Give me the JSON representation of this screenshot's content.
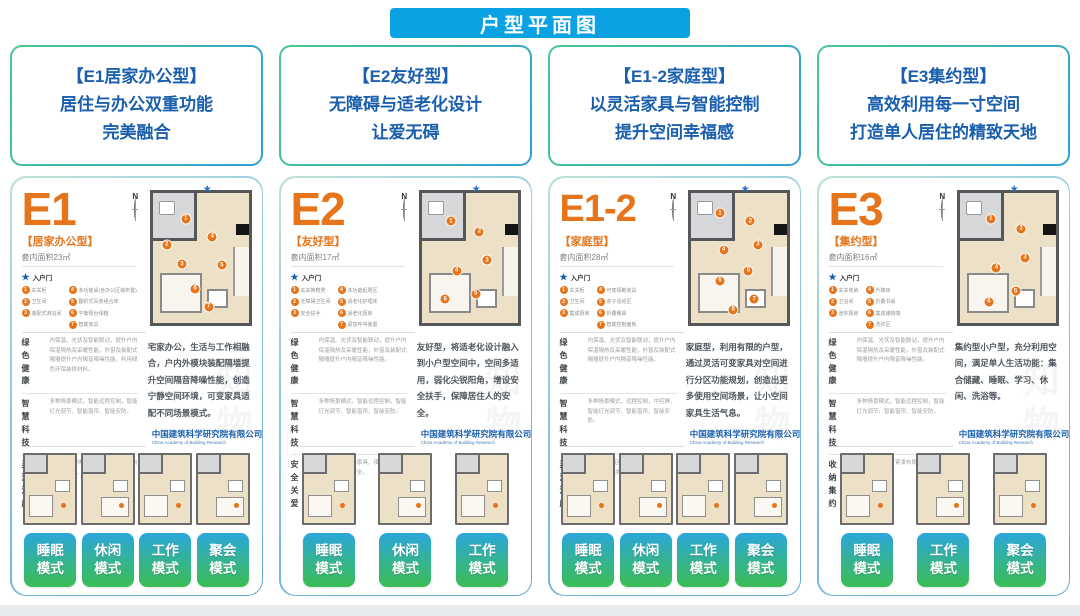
{
  "banner": {
    "title": "户型平面图"
  },
  "intro_cards": [
    {
      "title": "【E1居家办公型】",
      "line1": "居住与办公双重功能",
      "line2": "完美融合"
    },
    {
      "title": "【E2友好型】",
      "line1": "无障碍与适老化设计",
      "line2": "让爱无碍"
    },
    {
      "title": "【E1-2家庭型】",
      "line1": "以灵活家具与智能控制",
      "line2": "提升空间幸福感"
    },
    {
      "title": "【E3集约型】",
      "line1": "高效利用每一寸空间",
      "line2": "打造单人居住的精致天地"
    }
  ],
  "entry_label": "入户门",
  "compass_label": "N",
  "mode_suffix": "模式",
  "watermark": "知物",
  "logo": {
    "cn": "中国建筑科学研究院有限公司",
    "en": "China Academy of Building Research"
  },
  "panels": [
    {
      "code": "E1",
      "subtitle": "【居家办公型】",
      "area": "套内面积23㎡",
      "legend_left": [
        "玄关柜",
        "卫生间",
        "装配式淋浴间"
      ],
      "legend_right": [
        "多功能桌(含办公区域布置)",
        "翻折式百变组合床",
        "平衡阳台绿植",
        "智能家具"
      ],
      "sections": [
        {
          "label1": "绿 色",
          "label2": "健 康",
          "text": "内保温、光伏及智能联动，提升户内保温隔热及采暖性能，外窗及装配式隔墙提升户内隔音降噪性能，利用绿色环保装修材料。"
        },
        {
          "label1": "智 慧",
          "label2": "科 技",
          "text": "多种情景模式，智能远程控制，智能灯光调节、智能窗帘、智能安防。"
        },
        {
          "label1": "灵 活",
          "label2": "温 度",
          "text": "可变家具模块，平衡节省，丰富室内居家、办公、休闲场景。"
        }
      ],
      "description": "宅家办公，生活与工作相融合，户内外模块装配隔墙提升空间隔音降噪性能，创造宁静空间环境，可变家具适配不同场景模式。",
      "modes": [
        "睡眠",
        "休闲",
        "工作",
        "聚会"
      ]
    },
    {
      "code": "E2",
      "subtitle": "【友好型】",
      "area": "套内面积17㎡",
      "legend_left": [
        "玄关换鞋凳",
        "无障碍卫生间",
        "安全扶手"
      ],
      "legend_right": [
        "多功能起居区",
        "适老化护理床",
        "适老化厨房",
        "紧急呼叫装置"
      ],
      "sections": [
        {
          "label1": "绿 色",
          "label2": "健 康",
          "text": "内保温、光伏及智能联动，提升户内保温隔热及采暖性能，外窗及装配式隔墙提升户内隔音降噪性能。"
        },
        {
          "label1": "智 慧",
          "label2": "科 技",
          "text": "多种情景模式，智能远程控制，智能灯光调节、智能窗帘、智能安防。"
        },
        {
          "label1": "安 全",
          "label2": "关 爱",
          "text": "安全扶手、圆角家具、夜间照明，保障老年人起居安全。"
        }
      ],
      "description": "友好型，将适老化设计融入到小户型空间中，空间多适用，弱化尖锐阳角，增设安全扶手，保障居住人的安全。",
      "modes": [
        "睡眠",
        "休闲",
        "工作"
      ]
    },
    {
      "code": "E1-2",
      "subtitle": "【家庭型】",
      "area": "套内面积28㎡",
      "legend_left": [
        "玄关柜",
        "卫生间",
        "集成厨房"
      ],
      "legend_right": [
        "可变隔断家具",
        "亲子活动区",
        "折叠餐桌",
        "智能控制面板"
      ],
      "sections": [
        {
          "label1": "绿 色",
          "label2": "健 康",
          "text": "内保温、光伏及智能联动，提升户内保温隔热及采暖性能，外窗及装配式隔墙提升户内隔音降噪性能。"
        },
        {
          "label1": "智 慧",
          "label2": "科 技",
          "text": "多种情景模式，远程控制，中控屏、智能灯光调节、智能窗帘、智能安防。"
        },
        {
          "label1": "灵 活",
          "label2": "温 度",
          "text": "可变家具分区，满足家庭起居、学习、聚会多场景需求。"
        }
      ],
      "description": "家庭型，利用有限的户型，通过灵活可变家具对空间进行分区功能规划，创造出更多使用空间场景，让小空间家具生活气息。",
      "modes": [
        "睡眠",
        "休闲",
        "工作",
        "聚会"
      ]
    },
    {
      "code": "E3",
      "subtitle": "【集约型】",
      "area": "套内面积16㎡",
      "legend_left": [
        "玄关收纳",
        "卫浴间",
        "迷你厨房"
      ],
      "legend_right": [
        "升降床",
        "折叠书桌",
        "集成储物墙",
        "洗衣区"
      ],
      "sections": [
        {
          "label1": "绿 色",
          "label2": "健 康",
          "text": "内保温、光伏及智能联动，提升户内保温隔热及采暖性能，外窗及装配式隔墙提升户内隔音降噪性能。"
        },
        {
          "label1": "智 慧",
          "label2": "科 技",
          "text": "多种情景模式，智能远程控制，智能灯光调节、智能窗帘、智能安防。"
        },
        {
          "label1": "收 纳",
          "label2": "集 约",
          "text": "集成收纳体系，紧凑布局，满足单人高效生活。"
        }
      ],
      "description": "集约型小户型，充分利用空间，满足单人生活功能：集合储藏、睡眠、学习、休闲、洗浴等。",
      "modes": [
        "睡眠",
        "工作",
        "聚会"
      ]
    }
  ],
  "colors": {
    "banner_blue": "#0aa2e2",
    "title_blue": "#1a5fae",
    "accent_orange": "#e5741b",
    "badge_gradient_top": "#2ba6dc",
    "badge_gradient_bottom": "#3cbd55",
    "card_border_green": "#49c98e",
    "card_border_blue": "#2f9fd8"
  }
}
